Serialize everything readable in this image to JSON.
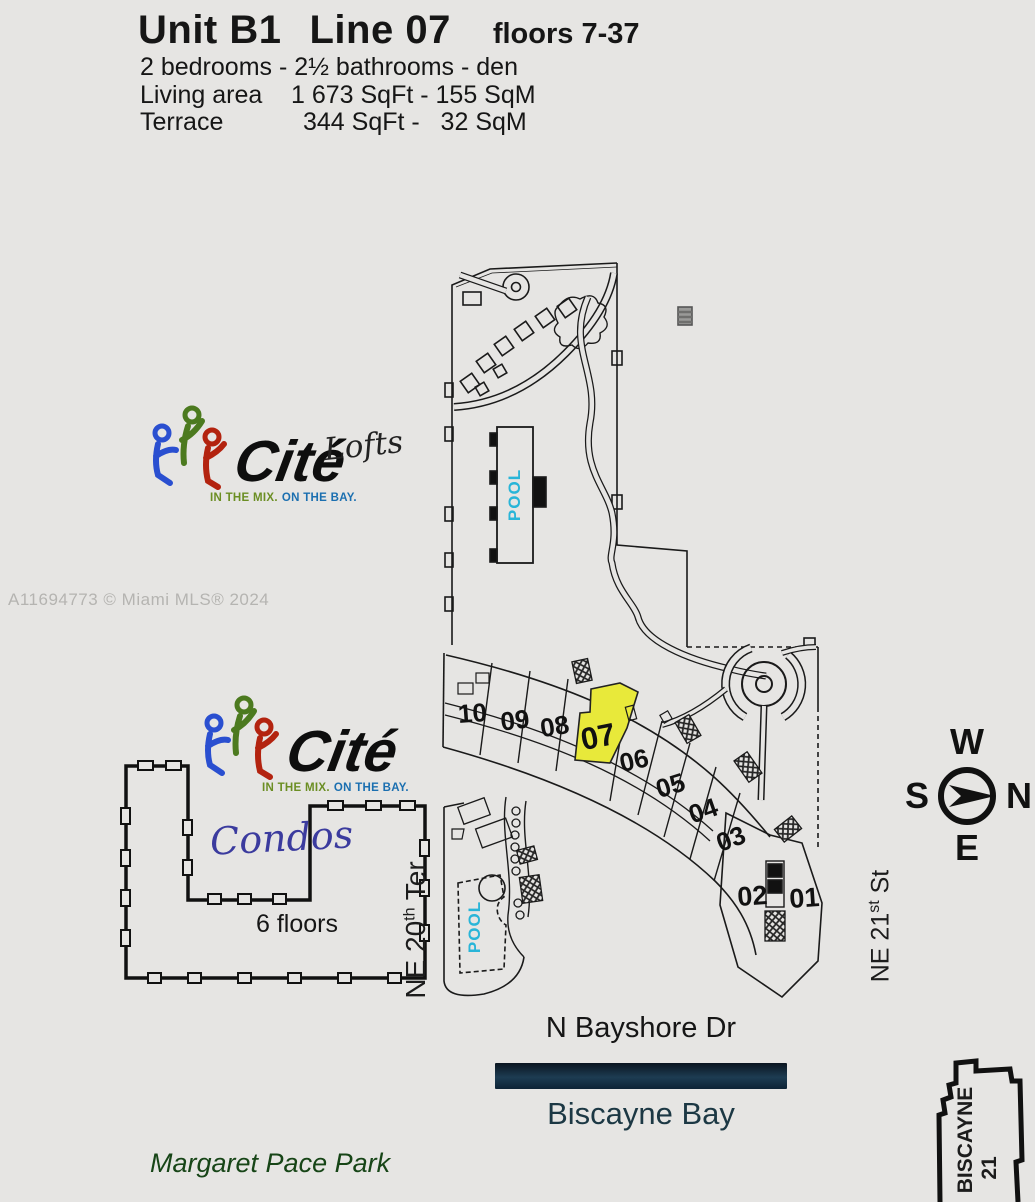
{
  "header": {
    "unit": "Unit B1",
    "line": "Line 07",
    "floors": "floors 7-37",
    "bed_bath": "2 bedrooms - 2½ bathrooms - den",
    "living_label": "Living area",
    "living_value": "1 673 SqFt - 155 SqM",
    "terrace_label": "Terrace",
    "terrace_value": "344 SqFt -   32 SqM"
  },
  "watermark": "A11694773 © Miami MLS® 2024",
  "logo_lofts": {
    "brand": "Cité",
    "tagline_mix": "IN THE MIX.",
    "tagline_bay": "ON THE BAY.",
    "label": "Lofts"
  },
  "logo_condos": {
    "brand": "Cité",
    "tagline_mix": "IN THE MIX.",
    "tagline_bay": "ON THE BAY.",
    "label": "Condos",
    "floors_note": "6 floors"
  },
  "site_plan": {
    "pool_upper_label": "POOL",
    "pool_lower_label": "POOL",
    "unit_labels": [
      "10",
      "09",
      "08",
      "07",
      "06",
      "05",
      "04",
      "03",
      "02",
      "01"
    ],
    "highlighted_unit": "07"
  },
  "compass": {
    "n": "N",
    "s": "S",
    "e": "E",
    "w": "W"
  },
  "labels": {
    "ne20_base": "NE 20",
    "ne20_sup": "th",
    "ne20_tail": " Ter",
    "ne21_base": "NE 21",
    "ne21_sup": "st",
    "ne21_tail": " St",
    "bayshore": "N Bayshore Dr",
    "bay": "Biscayne Bay",
    "park": "Margaret Pace Park",
    "biscayne21_top": "BISCAYNE",
    "biscayne21_bottom": "21"
  },
  "colors": {
    "pool_text": "#29b5d8",
    "highlight": "#e8e93a",
    "tagline_mix": "#6b8e23",
    "tagline_bay": "#1b6fb0",
    "condos_text": "#3b3b9e"
  }
}
